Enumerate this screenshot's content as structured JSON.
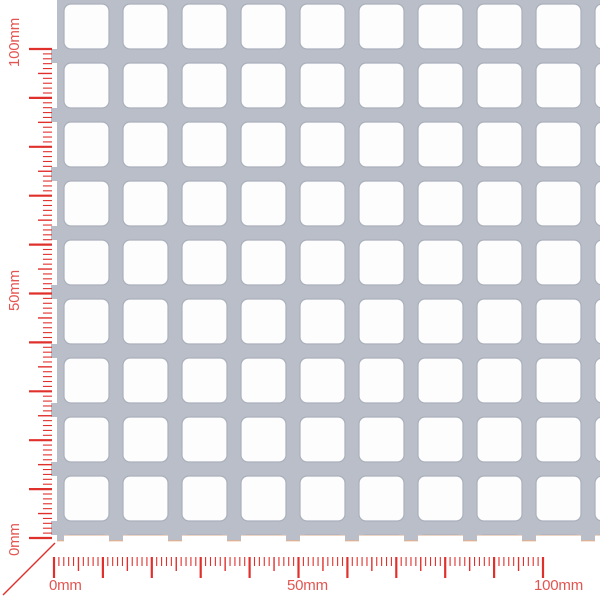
{
  "sheet": {
    "description": "perforated metal sheet preview, square holes in straight rows",
    "metal_color": "#b9bec8",
    "hole_color": "#fdfdfd",
    "hole_edge_color": "#aab0bb",
    "cut_edge_tint": "#d9a07a"
  },
  "rulers": {
    "unit": "mm",
    "tick_color": "#e0302c",
    "label_color": "#e25551",
    "horizontal": {
      "min_mm": 0,
      "max_mm": 100,
      "minor_step_mm": 1,
      "medium_step_mm": 5,
      "major_step_mm": 10,
      "labels": [
        {
          "mm": 0,
          "text": "0mm"
        },
        {
          "mm": 50,
          "text": "50mm"
        },
        {
          "mm": 100,
          "text": "100mm"
        }
      ]
    },
    "vertical": {
      "min_mm": 0,
      "max_mm": 100,
      "minor_step_mm": 1,
      "medium_step_mm": 5,
      "major_step_mm": 10,
      "labels": [
        {
          "mm": 0,
          "text": "0mm"
        },
        {
          "mm": 50,
          "text": "50mm"
        },
        {
          "mm": 100,
          "text": "100mm"
        }
      ]
    }
  }
}
